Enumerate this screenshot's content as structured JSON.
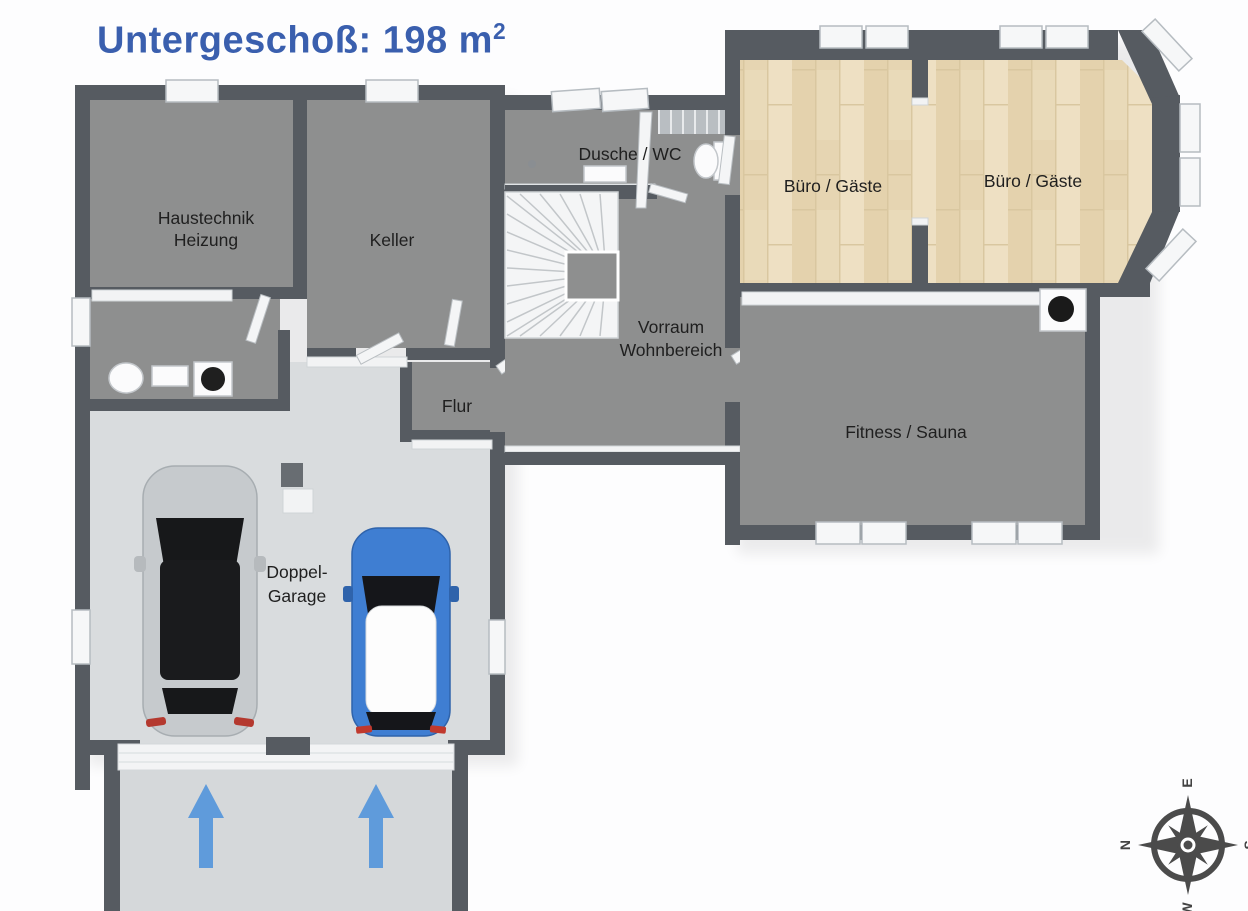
{
  "title": {
    "text": "Untergeschoß: 198 m",
    "superscript": "2"
  },
  "rooms": {
    "haustechnik": {
      "line1": "Haustechnik",
      "line2": "Heizung"
    },
    "keller": {
      "label": "Keller"
    },
    "dusche_wc": {
      "label": "Dusche / WC"
    },
    "buero1": {
      "label": "Büro / Gäste"
    },
    "buero2": {
      "label": "Büro / Gäste"
    },
    "vorraum": {
      "line1": "Vorraum",
      "line2": "Wohnbereich"
    },
    "flur": {
      "label": "Flur"
    },
    "fitness": {
      "label": "Fitness / Sauna"
    },
    "garage": {
      "line1": "Doppel-",
      "line2": "Garage"
    }
  },
  "compass": {
    "north": "N",
    "east": "E",
    "south": "S",
    "west": "W"
  },
  "cars": [
    {
      "name": "silver car",
      "color": "#c6cacd"
    },
    {
      "name": "blue car",
      "color": "#3f7ed2"
    }
  ],
  "entrance": {
    "arrow_count": 2
  },
  "colors": {
    "title": "#3a5fae",
    "wall": "#565b61",
    "room_floor": "#8e8f8f",
    "wood_floor": "#e8d8b6",
    "garage_floor": "#d9dcde",
    "driveway": "#d5d8da",
    "arrow": "#5f9bdb",
    "label": "#1f1f1f"
  }
}
